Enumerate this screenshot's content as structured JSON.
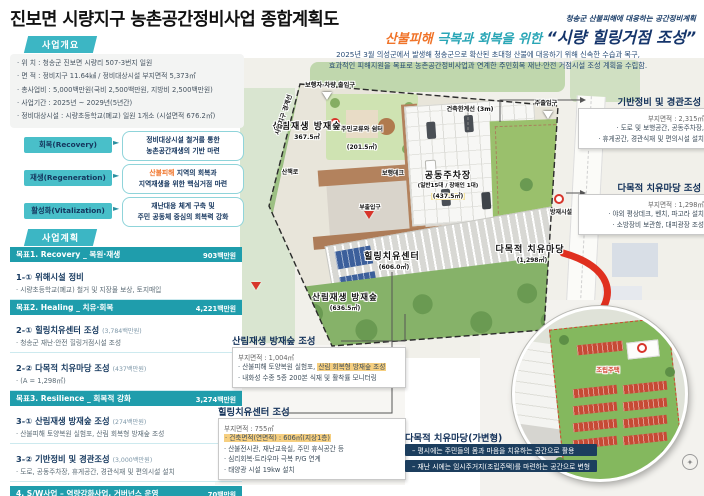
{
  "page": {
    "title": "진보면 시량지구 농촌공간정비사업 종합계획도"
  },
  "colors": {
    "accent_teal": "#2fb0bf",
    "navy": "#14325a",
    "orange": "#f0742a",
    "goal_teal": "#1f9dac",
    "highlight": "#f6cf80",
    "red": "#e0301f"
  },
  "overview": {
    "header": "사업개요",
    "items": [
      "· 위    치 : 청송군 진보면 시량리 507-3번지 일원",
      "· 면    적 : 정비지구 11.64㎢ / 정비대상시설 부지면적 5,373㎡",
      "· 총사업비 : 5,000백만원(국비 2,500백만원, 지방비 2,500백만원)",
      "· 사업기간 : 2025년 ~ 2029년(5년간)",
      "· 정비대상시설 : 시량초등학교(폐교) 일원 1개소 (시설면적 676.2㎡)"
    ]
  },
  "strategies": [
    {
      "label": "회복(Recovery)",
      "d1a": "",
      "d1b": "정비대상시설 철거를 통한",
      "d2": "농촌공간재생의 기반 마련"
    },
    {
      "label": "재생(Regeneration)",
      "d1a": "산불피해",
      "d1b": " 지역의 회복과",
      "d2": "지역재생을 위한 핵심거점 마련"
    },
    {
      "label": "활성화(Vitalization)",
      "d1a": "",
      "d1b": "재난대응 체계 구축 및",
      "d2": "주민 공동체 중심의 회복력 강화"
    }
  ],
  "plan": {
    "header": "사업계획",
    "sections": [
      {
        "kind": "goal",
        "title": "목표1. Recovery _ 복원·재생",
        "amount": "903백만원"
      },
      {
        "kind": "item",
        "title": "1-① 위해시설 정비",
        "amount": "",
        "bullets": [
          "· 시량초등학교(폐교) 철거 및 지장물 보상, 토지매입"
        ]
      },
      {
        "kind": "goal",
        "title": "목표2. Healing _ 치유·회복",
        "amount": "4,221백만원"
      },
      {
        "kind": "item",
        "title": "2-① 힐링치유센터 조성",
        "amount": "(3,784백만원)",
        "bullets": [
          "· 청송군 재난·안전 힐링거점시설 조성"
        ]
      },
      {
        "kind": "item",
        "title": "2-② 다목적 치유마당 조성",
        "amount": "(437백만원)",
        "bullets": [
          "· (A = 1,298㎡)"
        ]
      },
      {
        "kind": "goal",
        "title": "목표3. Resilience _ 회복적 강화",
        "amount": "3,274백만원"
      },
      {
        "kind": "item",
        "title": "3-① 산림재생 방재숲 조성",
        "amount": "(274백만원)",
        "bullets": [
          "· 산불피해 토양복원 실험포, 산림 회복형 방재숲 조성"
        ]
      },
      {
        "kind": "item",
        "title": "3-② 기반정비 및 경관조성",
        "amount": "(3,000백만원)",
        "bullets": [
          "· 도로, 공동주차장, 휴게공간, 경관식재 및 편의시설 설치"
        ]
      },
      {
        "kind": "goal",
        "title": "4. S/W사업 – 역량강화사업, 거버넌스 운영",
        "amount": "70백만원"
      },
      {
        "kind": "goal",
        "title": "5. 부대비용 – 기본계획, 세부설계, 공사감리 등",
        "amount": "634백만원"
      }
    ]
  },
  "headline": {
    "tagline": "청송군 산불피해에 대응하는 공간정비계획",
    "lead_accent": "산불피해",
    "lead_rest": " 극복과 회복을 위한 ",
    "quote": "“시량 힐링거점 조성”",
    "body1": "2025년 3월 의성군에서 발생해 청송군으로 확산된 초대형 산불에 대응하기 위해 신속한 수습과 복구,",
    "body2": "효과적인 피해지원을 목표로 농촌공간정비사업과 연계한 주민회복 재난·안전 거점시설 조성 계획을 수립함."
  },
  "map": {
    "boundary_label": "사업지구 경계선",
    "entrance_top_left": "보행자·차량 출입구",
    "entrance_top_right": "주출입구",
    "setback_line": "건축한계선 (3m)",
    "trail": "산책로",
    "deck": "보행데크",
    "sub_entrance": "부출입구",
    "disaster_facility": "방재시설",
    "zones": {
      "forest1": {
        "name": "산림재생 방재숲",
        "area": "367.5㎡"
      },
      "garden": {
        "name": "주민교류와 쉼터",
        "area": "(201.5㎡)"
      },
      "parking": {
        "name": "공동주차장",
        "sub": "(일반15대 / 장애인 1대)",
        "area": "(437.5㎡)"
      },
      "center": {
        "name": "힐링치유센터",
        "area": "(606.0㎡)"
      },
      "forest2": {
        "name": "산림재생 방재숲",
        "area": "(636.5㎡)"
      },
      "madang": {
        "name": "다목적 치유마당",
        "area": "(1,298㎡)"
      }
    },
    "inset_label": "조립주택"
  },
  "callouts": {
    "basis": {
      "title": "기반정비 및 경관조성",
      "area": "부지면적 : 2,315㎡",
      "b1": "· 도로 및 보행공간, 공동주차장,",
      "b2": "· 휴게공간, 경관식재 및 편의시설 설치"
    },
    "madang": {
      "title": "다목적 치유마당 조성",
      "area": "부지면적 : 1,298㎡",
      "b1": "· 야외 평상데크, 벤치, 파고라 설치",
      "b2": "· 소방장비 보관함, 대피광장 조성"
    },
    "forest": {
      "title": "산림재생 방재숲 조성",
      "area": "부지면적 : 1,004㎡",
      "b1_pre": "· 산불피해 토양복원 실험포, ",
      "b1_hl": "산림 회복형 방재숲 조성",
      "b2": "· 내화성 수종 5종 200본 식재 및 활착률 모니터링"
    },
    "center": {
      "title": "힐링치유센터 조성",
      "area": "부지면적 : 755㎡",
      "hl": "· 건축면적(연면적) : 606㎡(지상1층)",
      "b1": "· 산불전시관, 재난교육실, 주민 휴식공간 등",
      "b2": "· 심리회복·트라우마 극복 P/G 연계",
      "b3": "· 태양광 시설 19kw 설치"
    },
    "variable": {
      "title": "다목적 치유마당(가변형)",
      "l1": "– 평시에는 주민들의 몸과 마음을 치유하는 공간으로 활용",
      "l2": "– 재난 시에는 임시주거지(조립주택)를 마련하는 공간으로 변형"
    }
  }
}
